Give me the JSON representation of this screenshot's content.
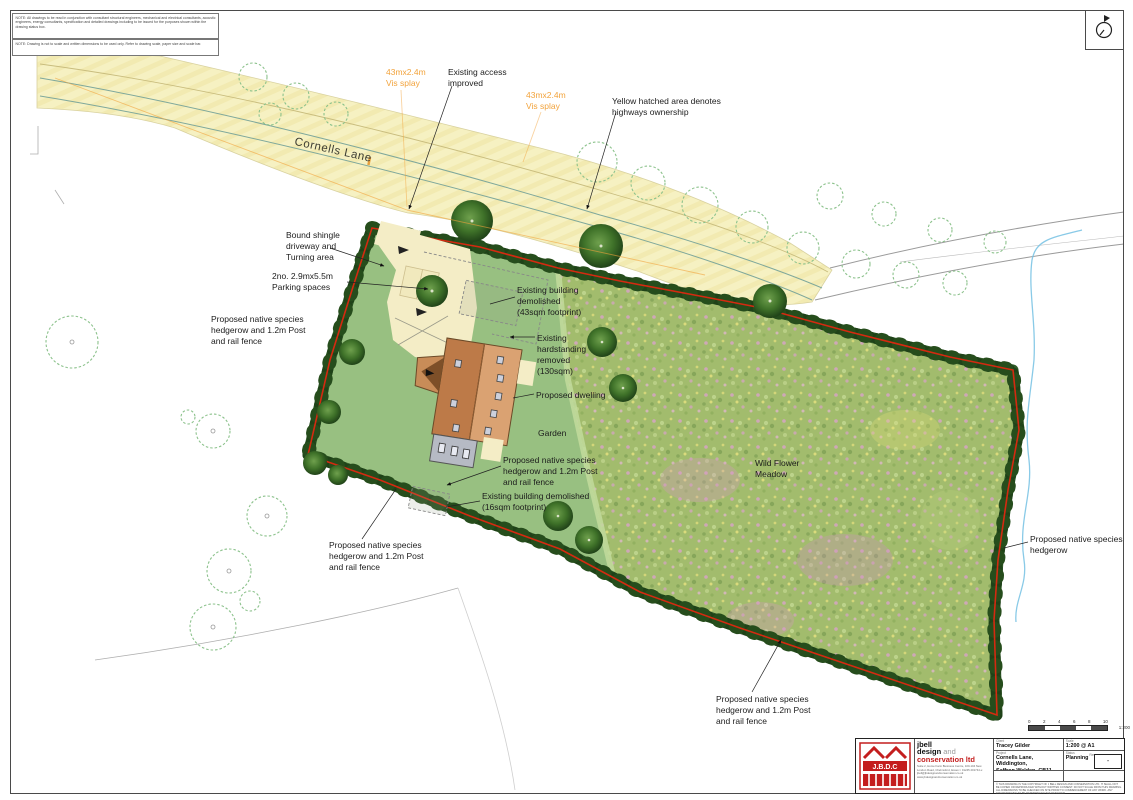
{
  "notes": [
    "NOTE:  All drawings to be read in conjunction with consultant structural engineers, mechanical and electrical consultants, acoustic engineers, energy consultants, specification and detailed drawings including to be issued for the purposes shown within the drawing status box.",
    "NOTE:  Drawing is not to scale and written dimensions to be used only. Refer to drawing scale, paper size and scale bar."
  ],
  "road": {
    "name": "Cornells Lane"
  },
  "ann": {
    "vis_splay": [
      "43mx2.4m",
      "Vis splay"
    ],
    "existing_access": [
      "Existing access",
      "improved"
    ],
    "highways": [
      "Yellow hatched area denotes",
      "highways ownership"
    ],
    "bound_shingle": [
      "Bound shingle",
      "driveway and",
      "Turning area"
    ],
    "parking": [
      "2no. 2.9mx5.5m",
      "Parking spaces"
    ],
    "hedgerow3": [
      "Proposed native species",
      "hedgerow and 1.2m Post",
      "and rail fence"
    ],
    "hedgerow2": [
      "Proposed native species",
      "hedgerow"
    ],
    "demo43": [
      "Existing building",
      "demolished",
      "(43sqm footprint)"
    ],
    "hardstanding": [
      "Existing",
      "hardstanding",
      "removed",
      "(130sqm)"
    ],
    "dwelling": "Proposed dwelling",
    "garden": "Garden",
    "demo16": [
      "Existing building demolished",
      "(16sqm footprint)"
    ],
    "wildflower": [
      "Wild Flower",
      "Meadow"
    ]
  },
  "scalebar": {
    "ticks": [
      "0",
      "2",
      "4",
      "6",
      "8",
      "10"
    ],
    "ratio": "1:200"
  },
  "titleblock": {
    "logo_text": "J.B.D.C",
    "company_line1": "jbell",
    "company_line2a": "design ",
    "company_line2b": "and",
    "company_line3": "conservation ltd",
    "address": "Suite 2, Home Farm Business Centre, 100-104 New London Road, Chelmsford, Essex  t: 01245 201744  e: jbell@jbdesignandconservation.co.uk  www.jbdesignandconservation.co.uk",
    "fields": {
      "client_label": "Client",
      "client_value": "Tracey Gilder",
      "project_label": "Project",
      "project_value1": "Cornells Lane, Widdington,",
      "project_value2": "Saffron Walden, CB11 3SP",
      "drawing_label": "Drawing",
      "drawing_value": "Proposed Site Plan",
      "scale_label": "Scale",
      "scale_value": "1:200 @ A1",
      "status_label": "Status",
      "status_value": "Planning",
      "rev_label": "Rev",
      "rev_value": "-",
      "drgno_label": "Drg No",
      "drgno_value": "2022-698-053"
    },
    "copyright": "© THIS DRAWING IS THE COPYRIGHT OF J BELL DESIGN AND CONSERVATION LTD. IT SHALL NOT BE COPIED OR REPRODUCED WITHOUT WRITTEN CONSENT. DO NOT SCALE FROM THIS DRAWING. ALL DIMENSIONS TO BE CHECKED ON SITE PRIOR TO COMMENCEMENT OF ANY WORK. ANY DISCREPANCIES TO BE REPORTED TO THE DESIGNER."
  }
}
